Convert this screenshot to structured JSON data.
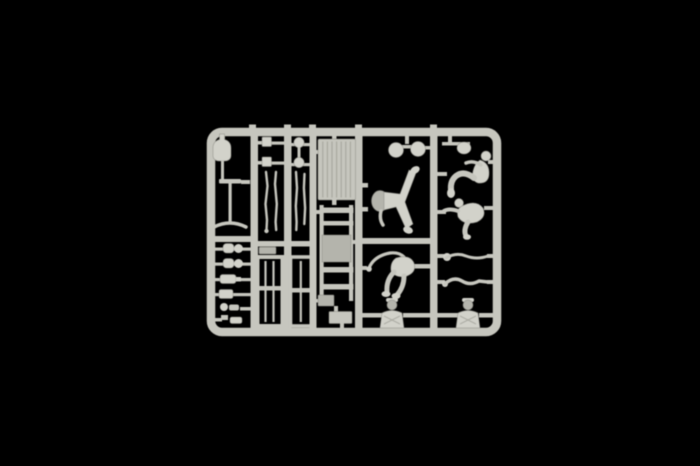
{
  "meta": {
    "type": "product-photograph",
    "subject": "injection-moulded plastic model kit sprue",
    "description": "Studio photograph of a light grey polystyrene model-kit sprue centred on a black background. The rectangular sprue frame with rounded corners holds furniture and figure parts: a planked table top, a trestle ladder frame, two slatted shutter frames, long thin leg rods, a bottle, jugs and cups, small fittings, two round helmets, a reclining figure with spread legs, a crouching figure, two seated figures, separate arm and leg parts and two uniformed busts."
  },
  "colors": {
    "background": "#000000",
    "sprue": "#c6c6be",
    "sprue_light": "#d2d2ca",
    "sprue_mid": "#b4b4ac",
    "sprue_shadow": "#84847c",
    "stripe": "#9c9c94"
  },
  "sprue": {
    "frame": {
      "left": 207,
      "top": 128,
      "width": 294,
      "height": 208,
      "rail_thickness": 8,
      "corner_radius": 11
    },
    "runner_count": 5,
    "parts": [
      {
        "name": "bottle",
        "location": "top-left"
      },
      {
        "name": "pedestal-table",
        "location": "left"
      },
      {
        "name": "jug",
        "location": "left"
      },
      {
        "name": "jug",
        "location": "left"
      },
      {
        "name": "flask",
        "location": "left"
      },
      {
        "name": "cup",
        "location": "left"
      },
      {
        "name": "small-fittings",
        "location": "bottom-left"
      },
      {
        "name": "square-connector",
        "location": "column-2-top"
      },
      {
        "name": "round-connector",
        "location": "column-3-top"
      },
      {
        "name": "long-thin-leg-rods",
        "location": "columns-2-3"
      },
      {
        "name": "slatted-frame",
        "location": "column-2-bottom"
      },
      {
        "name": "slatted-frame",
        "location": "column-3-bottom"
      },
      {
        "name": "planked-table-top",
        "location": "center-top"
      },
      {
        "name": "trestle-ladder-frame",
        "location": "center"
      },
      {
        "name": "small-blocks",
        "location": "center-bottom"
      },
      {
        "name": "helmet",
        "location": "center-right-top"
      },
      {
        "name": "helmet",
        "location": "center-right-top"
      },
      {
        "name": "reclining-figure-spread-legs",
        "location": "center-right"
      },
      {
        "name": "crouching-figure",
        "location": "center-right-lower"
      },
      {
        "name": "uniformed-bust",
        "location": "bottom-center-right"
      },
      {
        "name": "helmet-pouch",
        "location": "top-right"
      },
      {
        "name": "seated-figure-leaning",
        "location": "right-upper"
      },
      {
        "name": "seated-figure-bent",
        "location": "right-middle"
      },
      {
        "name": "leg-part",
        "location": "right-lower"
      },
      {
        "name": "arm-part",
        "location": "right-lower"
      },
      {
        "name": "uniformed-bust",
        "location": "bottom-right"
      }
    ]
  }
}
